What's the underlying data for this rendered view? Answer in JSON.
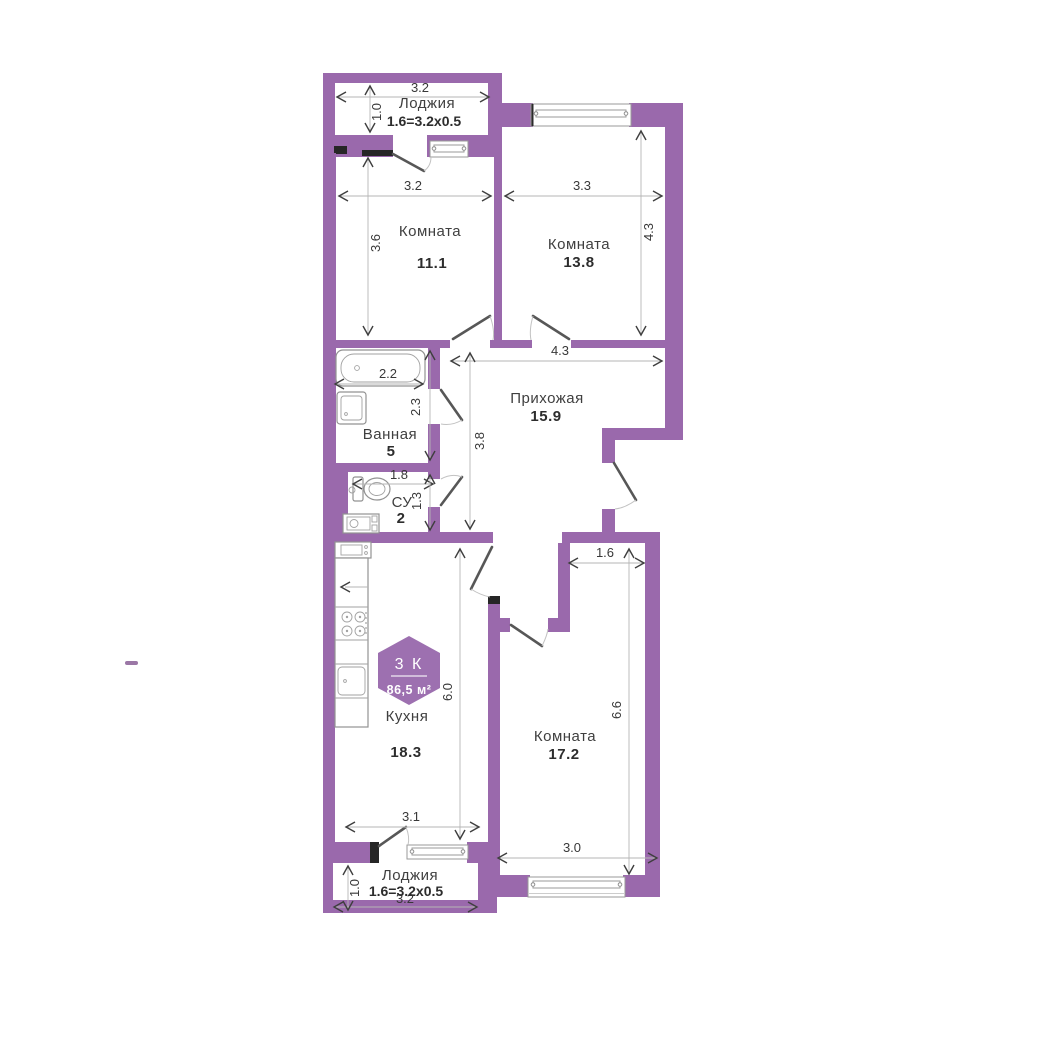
{
  "badge": {
    "rooms": "3 К",
    "area": "86,5 м²"
  },
  "rooms": {
    "loggia_top": {
      "name": "Лоджия",
      "area": "1.6=3.2x0.5"
    },
    "room_11": {
      "name": "Комната",
      "area": "11.1"
    },
    "room_13_8": {
      "name": "Комната",
      "area": "13.8"
    },
    "hallway": {
      "name": "Прихожая",
      "area": "15.9"
    },
    "bathroom": {
      "name": "Ванная",
      "area": "5"
    },
    "wc": {
      "name": "СУ",
      "area": "2"
    },
    "kitchen": {
      "name": "Кухня",
      "area": "18.3"
    },
    "room_17_2": {
      "name": "Комната",
      "area": "17.2"
    },
    "loggia_bottom": {
      "name": "Лоджия",
      "area": "1.6=3.2x0.5"
    }
  },
  "dimensions": {
    "loggia_top_width": "3.2",
    "loggia_top_depth": "1.0",
    "room_11_width": "3.2",
    "room_11_depth": "3.6",
    "room_13_8_width": "3.3",
    "room_13_8_depth": "4.3",
    "hallway_width": "4.3",
    "hallway_depth": "3.8",
    "bathroom_width": "2.2",
    "bathroom_depth": "2.3",
    "wc_width": "1.8",
    "wc_depth": "1.3",
    "niche_width": "1.6",
    "kitchen_depth": "6.0",
    "kitchen_width": "3.1",
    "room_17_2_depth": "6.6",
    "room_17_2_width": "3.0",
    "loggia_bottom_width": "3.2",
    "loggia_bottom_depth": "1.0"
  },
  "colors": {
    "wall": "#9a69ac",
    "badge": "#9d70b0"
  }
}
